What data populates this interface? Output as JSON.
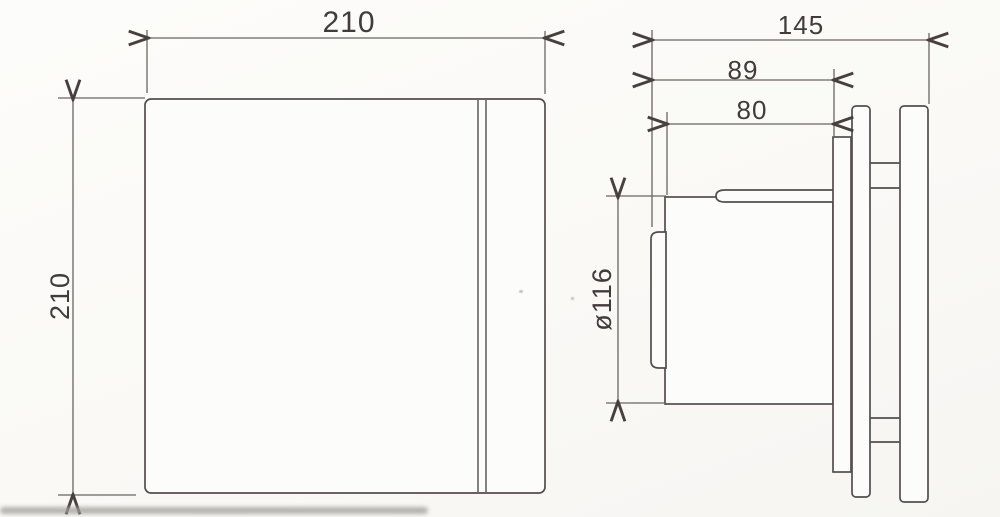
{
  "drawing": {
    "title": "extractor-fan-dimension-drawing",
    "front_view": {
      "name": "front view (fan face panel)",
      "width_mm": "210",
      "height_mm": "210"
    },
    "side_view": {
      "name": "side view (profile with wall plates)",
      "total_depth_mm": "145",
      "body_depth_with_cap_mm": "89",
      "duct_body_depth_mm": "80",
      "duct_diameter_mm": "ø116"
    },
    "colors": {
      "object_line": "#544d4e",
      "dimension_line": "#6b6561",
      "arrow": "#4a４442",
      "text": "#413b3c",
      "background": "#faf9f6"
    }
  }
}
